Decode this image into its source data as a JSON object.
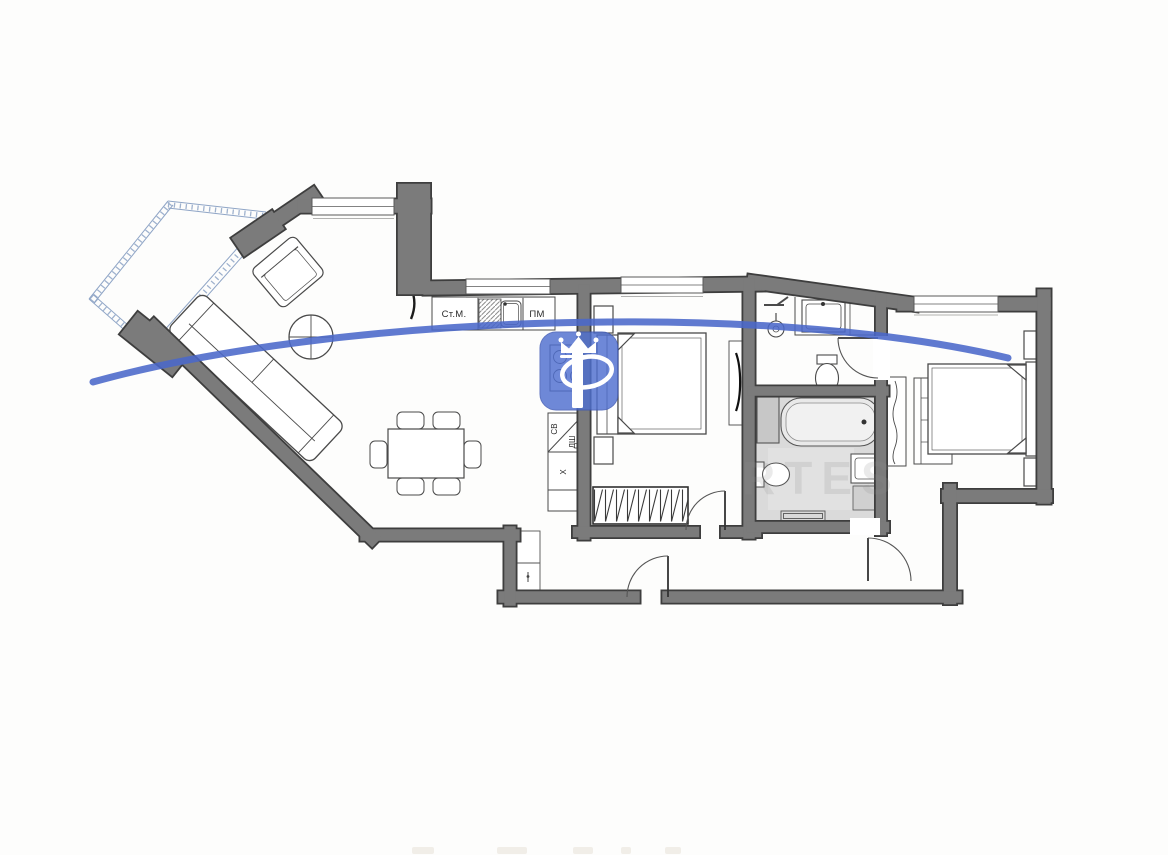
{
  "page": {
    "background": "#fdfdfc"
  },
  "plan": {
    "kitchen_labels": {
      "washing_machine": "Ст.М.",
      "dishwasher": "ПМ",
      "microwave": "СВ",
      "oven": "ДШ",
      "fridge": "Х"
    },
    "watermark": {
      "faint_text": "RTES",
      "logo_letter": "P",
      "blue": "#4a68ca",
      "logo_fill": "#4f6fd0"
    },
    "colors": {
      "wall_edge": "#3e3e3e",
      "wall_fill": "#7b7b7b",
      "furniture_line": "#4a4a4a",
      "bath_floor": "#dadada",
      "glazing_blue": "#8fa5c6",
      "fixture_gray": "#c9c9c9"
    }
  }
}
